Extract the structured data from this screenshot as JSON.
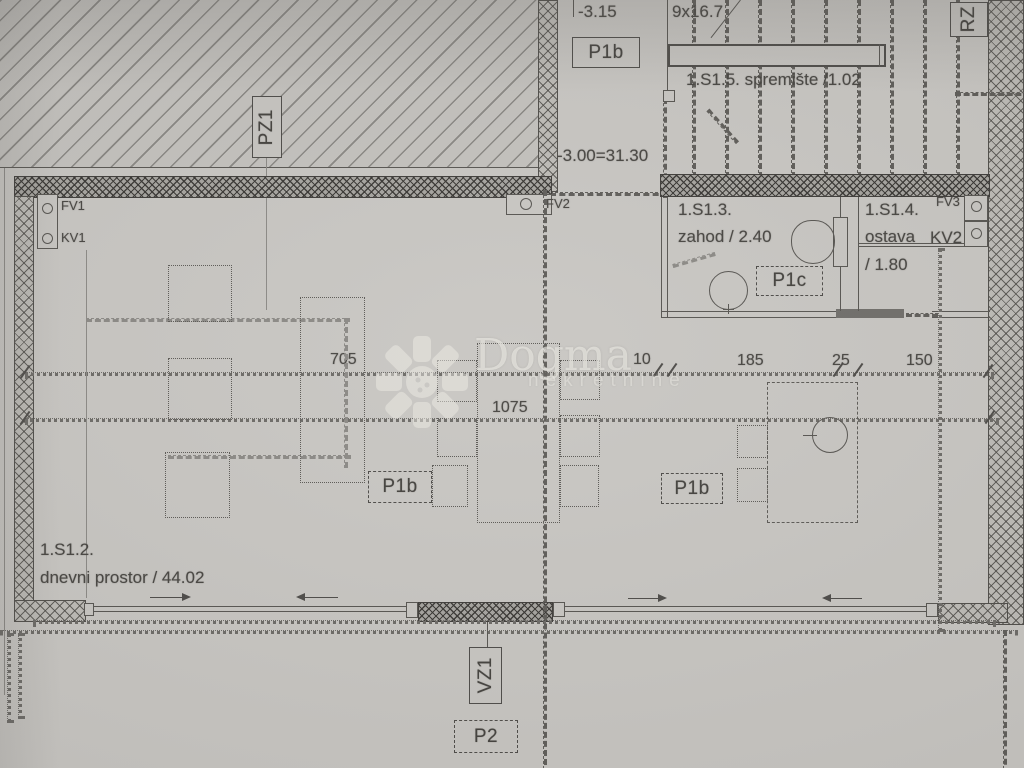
{
  "watermark": {
    "brand": "Dogma",
    "subtitle": "nekretnine",
    "logo": "pinwheel-flower-icon"
  },
  "rooms": {
    "living": {
      "id": "1.S1.2.",
      "label": "dnevni prostor / 44.02"
    },
    "wc": {
      "id": "1.S1.3.",
      "label": "zahod / 2.40"
    },
    "storage": {
      "id": "1.S1.4.",
      "name": "ostava",
      "area": "/ 1.80"
    },
    "understair": {
      "label": "1.S1.5. spremište /1.02"
    }
  },
  "levels": {
    "upper": "-3.15",
    "main": "-3.00=31.30"
  },
  "stairs": {
    "label": "9x16.7"
  },
  "tags": {
    "p1b": "P1b",
    "p1c": "P1c",
    "p2": "P2",
    "pz1": "PZ1",
    "vz1": "VZ1",
    "rz": "RZ"
  },
  "vents": {
    "fv1": "FV1",
    "kv1": "KV1",
    "fv2": "FV2",
    "fv3": "FV3",
    "kv2": "KV2"
  },
  "dimensions": {
    "d705": "705",
    "d1075": "1075",
    "d10": "10",
    "d185": "185",
    "d25": "25",
    "d150": "150"
  },
  "colors": {
    "paper": "#c8c6c2",
    "ink": "#4b4946",
    "wall_fill": "#a5a39e",
    "watermark": "#f0eee8"
  }
}
